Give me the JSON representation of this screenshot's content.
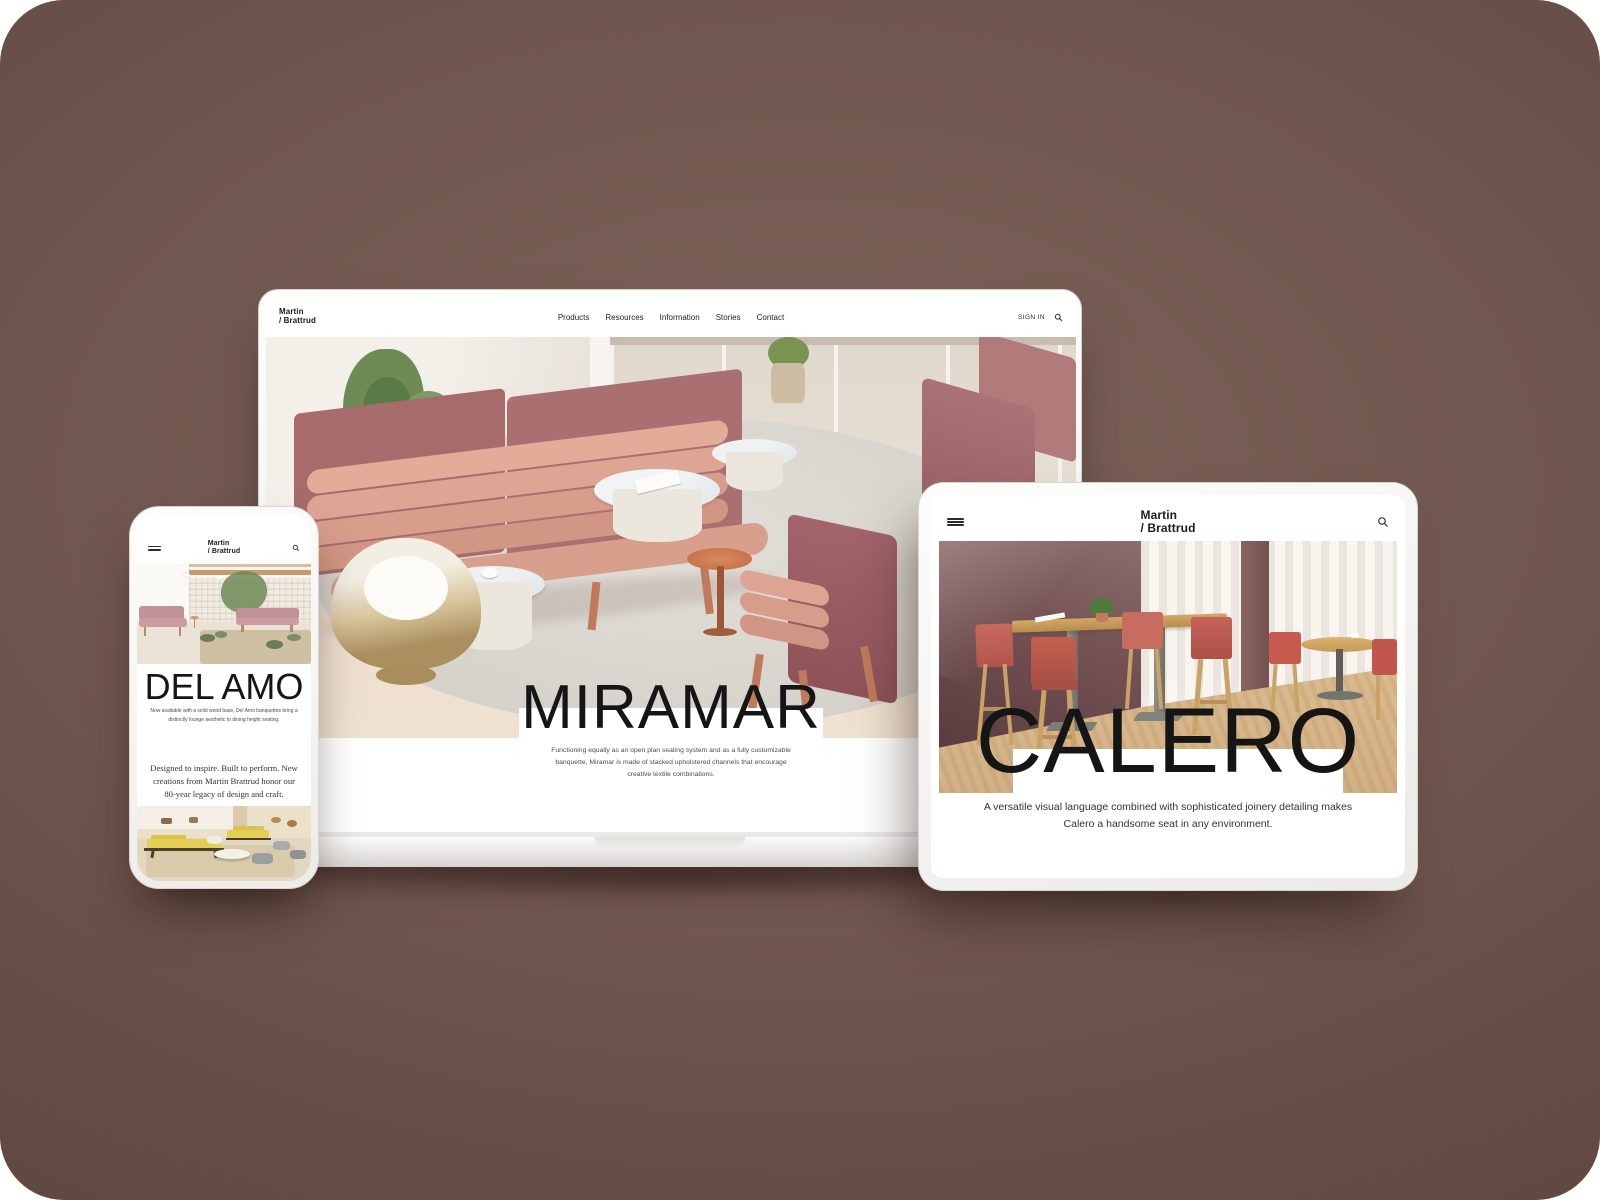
{
  "brand": {
    "line1": "Martin",
    "line2": "/ Brattrud"
  },
  "laptop": {
    "nav": {
      "items": [
        "Products",
        "Resources",
        "Information",
        "Stories",
        "Contact"
      ]
    },
    "sign_in": "SIGN IN",
    "hero": {
      "title": "MIRAMAR",
      "description": "Functioning equally as an open plan seating system and as a fully customizable banquette, Miramar is made of stacked upholstered channels that encourage creative textile combinations."
    }
  },
  "phone": {
    "hero": {
      "title": "DEL AMO",
      "description": "Now available with a solid wood base, Del Amo banquettes bring a distinctly lounge aesthetic to dining height seating."
    },
    "quote": "Designed to inspire. Built to perform. New creations from Martin Brattrud honor our 80-year legacy of design and craft."
  },
  "tablet": {
    "hero": {
      "title": "CALERO",
      "description": "A versatile visual language combined with sophisticated joinery detailing makes Calero a handsome seat in any environment."
    }
  },
  "icons": {
    "search": "search-icon",
    "menu": "menu-icon"
  },
  "colors": {
    "background_mid": "#7e645b",
    "background_edge": "#583f39",
    "rose_upholstery": "#a76b6c",
    "blush_channel": "#dea595",
    "coral_seat": "#c2604f",
    "wood": "#c9a265",
    "plum_wall": "#704e51"
  }
}
